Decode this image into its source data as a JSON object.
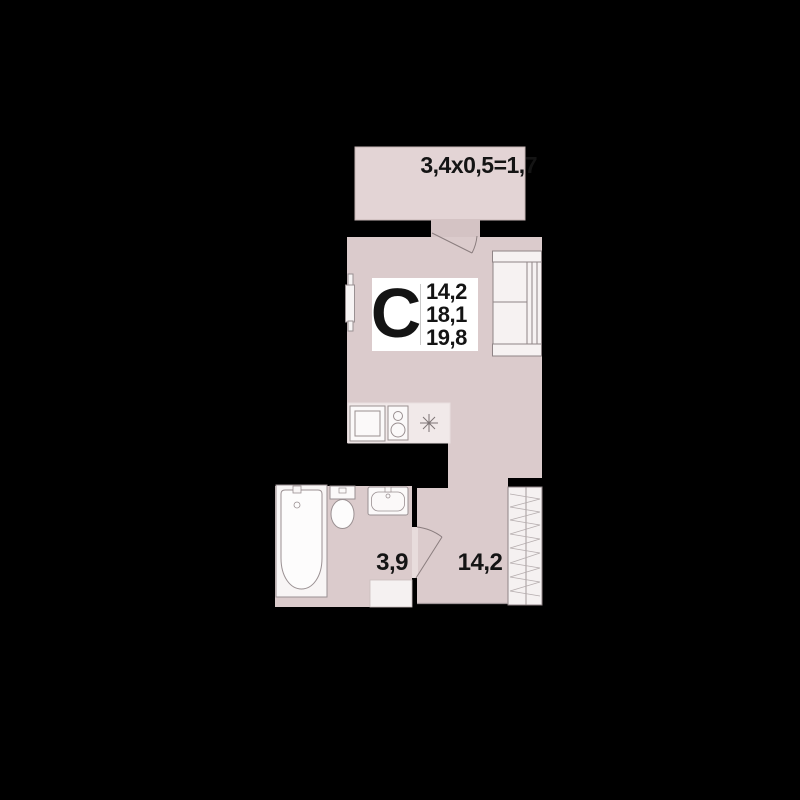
{
  "floorplan": {
    "unit_type_label": "С",
    "area_lines": [
      "14,2",
      "18,1",
      "19,8"
    ],
    "balcony_dimension": "3,4x0,5=1,7",
    "bathroom_area": "3,9",
    "hallway_area": "14,2",
    "rooms": [
      {
        "name": "studio-living-room",
        "label": "С"
      },
      {
        "name": "balcony",
        "dimension": "3,4x0,5=1,7"
      },
      {
        "name": "bathroom",
        "area": "3,9"
      },
      {
        "name": "hallway",
        "area": "14,2"
      }
    ],
    "fixtures": [
      "sofa",
      "wardrobe",
      "bathtub",
      "toilet",
      "washbasin",
      "kitchen-sink",
      "stove",
      "radiator",
      "vent-star"
    ],
    "colors": {
      "background": "#000000",
      "room_fill": "#dbcbcc",
      "balcony_fill": "#e3d4d5",
      "kitchen_fill": "#f1e9e9",
      "threshold_fill": "#e8dcdc",
      "fixture_fill": "#f8f5f5",
      "fixture_stroke": "#958b8c",
      "door_stroke": "#8a7d7e",
      "label_box": "#ffffff",
      "text": "#141414"
    }
  }
}
